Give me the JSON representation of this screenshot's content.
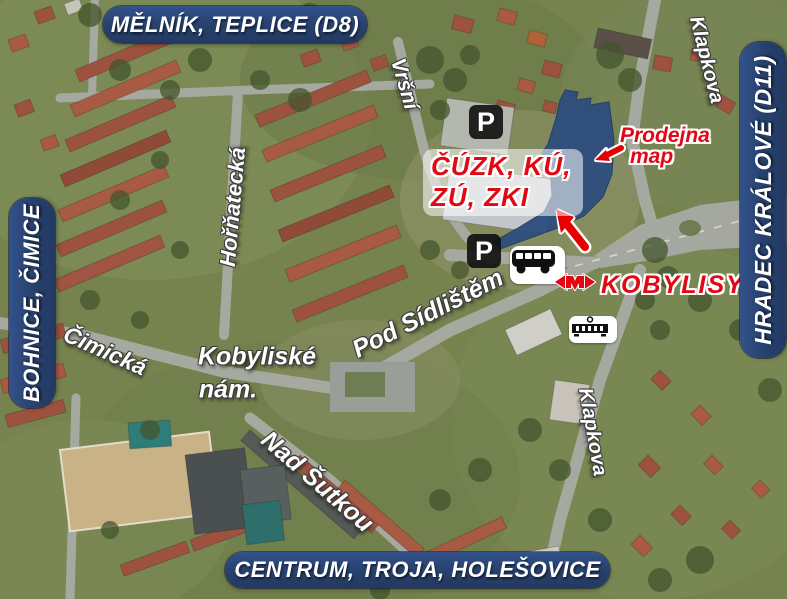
{
  "direction_banners": {
    "top": "MĚLNÍK, TEPLICE (D8)",
    "left": "BOHNICE, ČIMICE",
    "right": "HRADEC KRÁLOVÉ (D11)",
    "bottom": "CENTRUM, TROJA, HOLEŠOVICE"
  },
  "street_labels": {
    "vrsni": "Vršní",
    "hornatecka": "Hořňatecká",
    "cimicka": "Čimická",
    "kobyliske_nam_line1": "Kobyliské",
    "kobyliske_nam_line2": "nám.",
    "pod_sidlistem": "Pod Sídlištěm",
    "nad_sutkou": "Nad Šutkou",
    "klapkova_north": "Klapkova",
    "klapkova_south": "Klapkova"
  },
  "landmarks": {
    "office_line1": "ČÚZK, KÚ,",
    "office_line2": "ZÚ, ZKI",
    "map_shop_line1": "Prodejna",
    "map_shop_line2": "map",
    "metro_station_name": "KOBYLISY",
    "parking_symbol": "P"
  },
  "icons": [
    "parking-icon",
    "bus-icon",
    "tram-icon",
    "prague-metro-logo",
    "arrow-to-entrance",
    "arrow-to-map-shop"
  ],
  "colors": {
    "banner_navy": "#27406c",
    "highlight_building_navy": "#2e4d7e",
    "label_red": "#e30613",
    "street_label_white": "#ffffff",
    "parking_black": "#0f0f0f"
  }
}
